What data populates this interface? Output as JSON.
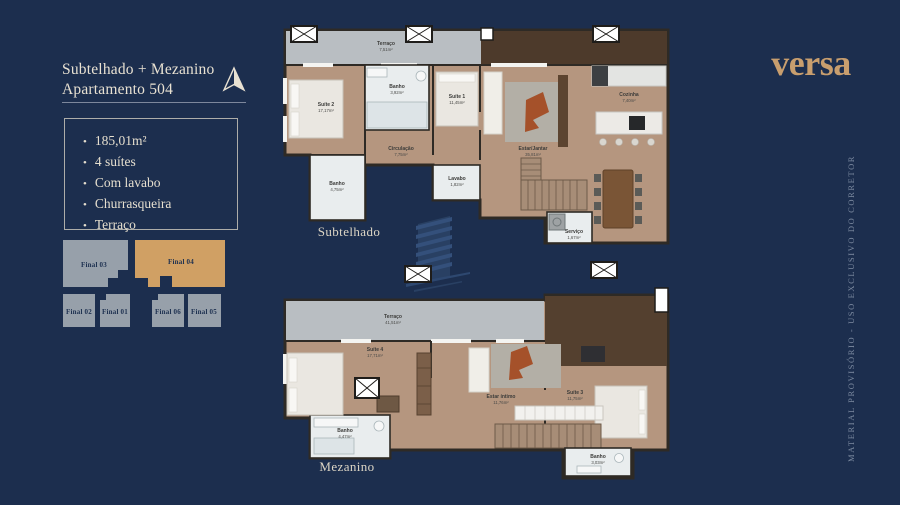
{
  "brand": {
    "logo_text": "versa"
  },
  "header": {
    "title_line1": "Subtelhado + Mezanino",
    "title_line2": "Apartamento 504"
  },
  "features": {
    "items": [
      "185,01m²",
      "4 suítes",
      "Com lavabo",
      "Churrasqueira",
      "Terraço"
    ]
  },
  "keyplan": {
    "units": [
      {
        "id": "final-03",
        "label": "Final 03",
        "highlighted": false
      },
      {
        "id": "final-04",
        "label": "Final 04",
        "highlighted": true
      },
      {
        "id": "final-02",
        "label": "Final 02",
        "highlighted": false
      },
      {
        "id": "final-01",
        "label": "Final 01",
        "highlighted": false
      },
      {
        "id": "final-06",
        "label": "Final 06",
        "highlighted": false
      },
      {
        "id": "final-05",
        "label": "Final 05",
        "highlighted": false
      }
    ]
  },
  "plans": {
    "subtelhado": {
      "caption": "Subtelhado",
      "rooms": [
        {
          "name": "Terraço",
          "area": "7,51m²"
        },
        {
          "name": "Suíte 2",
          "area": "17,17m²"
        },
        {
          "name": "Banho",
          "area": "3,92m²"
        },
        {
          "name": "Suíte 1",
          "area": "11,45m²"
        },
        {
          "name": "Estar/Jantar",
          "area": "35,81m²"
        },
        {
          "name": "Cozinha",
          "area": "7,40m²"
        },
        {
          "name": "Circulação",
          "area": "7,75m²"
        },
        {
          "name": "Lavabo",
          "area": "1,82m²"
        },
        {
          "name": "Banho",
          "area": "4,75m²"
        },
        {
          "name": "Serviço",
          "area": "1,67m²"
        }
      ]
    },
    "mezanino": {
      "caption": "Mezanino",
      "rooms": [
        {
          "name": "Terraço",
          "area": "41,51m²"
        },
        {
          "name": "Suíte 4",
          "area": "17,71m²"
        },
        {
          "name": "Banho",
          "area": "4,47m²"
        },
        {
          "name": "Estar íntimo",
          "area": "11,76m²"
        },
        {
          "name": "Suíte 3",
          "area": "11,75m²"
        },
        {
          "name": "Banho",
          "area": "3,03m²"
        }
      ]
    }
  },
  "legal": {
    "vertical_note": "MATERIAL PROVISÓRIO - USO EXCLUSIVO DO CORRETOR"
  },
  "colors": {
    "background": "#1c2e4e",
    "accent_gold": "#c89e6e",
    "keyplan_highlight": "#d0a064",
    "keyplan_unit": "#97a0aa",
    "cream_text": "#e6dfcf",
    "wood_floor": "#b5967f",
    "terrace_gray": "#b9bec2",
    "roof_brown": "#54402f"
  }
}
